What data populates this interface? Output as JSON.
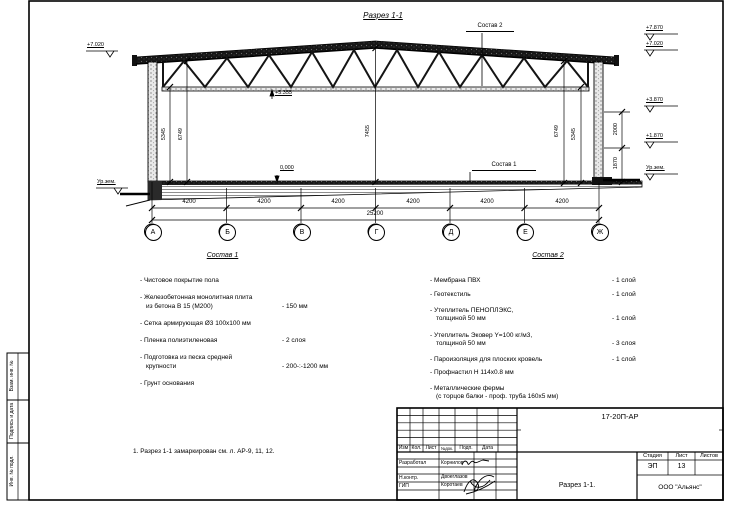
{
  "drawing": {
    "title": "Разрез 1-1",
    "note": "1. Разрез 1-1 замаркирован см. л. АР-9, 11, 12.",
    "callouts": {
      "roof": "Состав 2",
      "floor": "Состав 1"
    },
    "elevations": {
      "left_top": "+7.020",
      "left_ground": "Ур.зем.",
      "right_1": "+7.870",
      "right_2": "+7.020",
      "right_3": "+3.870",
      "right_4": "+1.870",
      "right_ground": "Ур.зем.",
      "truss_bottom": "+5.355",
      "floor_level": "0,000"
    },
    "dims": {
      "v_left_1": "5345",
      "v_left_2": "6749",
      "v_center": "7455",
      "v_right_1": "6749",
      "v_right_2": "5345",
      "side_upper": "2000",
      "side_lower": "1870",
      "spans": [
        "4200",
        "4200",
        "4200",
        "4200",
        "4200",
        "4200"
      ],
      "total": "25200"
    },
    "axes": [
      "А",
      "Б",
      "В",
      "Г",
      "Д",
      "Е",
      "Ж"
    ]
  },
  "sostav1": {
    "title": "Состав 1",
    "items": [
      {
        "text": "- Чистовое покрытие пола",
        "text2": "",
        "value": ""
      },
      {
        "text": "- Железобетонная  монолитная плита",
        "text2": "из бетона В 15 (М200)",
        "value": "- 150 мм"
      },
      {
        "text": "- Сетка армирующая Ø3 100х100 мм",
        "text2": "",
        "value": ""
      },
      {
        "text": "- Пленка полиэтиленовая",
        "text2": "",
        "value": "- 2 слоя"
      },
      {
        "text": "- Подготовка из песка средней",
        "text2": "крупности",
        "value": "- 200-:-1200 мм"
      },
      {
        "text": "- Грунт основания",
        "text2": "",
        "value": ""
      }
    ]
  },
  "sostav2": {
    "title": "Состав 2",
    "items": [
      {
        "text": "- Мембрана ПВХ",
        "text2": "",
        "value": "- 1 слой"
      },
      {
        "text": "- Геотекстиль",
        "text2": "",
        "value": "- 1 слой"
      },
      {
        "text": "- Утеплитель ПЕНОПЛЭКС,",
        "text2": "толщиной 50 мм",
        "value": "- 1 слой"
      },
      {
        "text": "- Утеплитель Эковер Y=100 кг/м3,",
        "text2": "толщиной 50 мм",
        "value": "- 3 слоя"
      },
      {
        "text": "- Пароизоляция для плоских кровель",
        "text2": "",
        "value": "- 1 слой"
      },
      {
        "text": "- Профнастил Н 114х0.8 мм",
        "text2": "",
        "value": ""
      },
      {
        "text": "- Металлические фермы",
        "text2": "(с торцов балки - проф. труба 160х5 мм)",
        "value": ""
      }
    ]
  },
  "titleblock": {
    "doc_number": "17-20П-АР",
    "headers": {
      "izm": "Изм",
      "kol": "Кол.",
      "list": "Лист",
      "ndok": "№док.",
      "podp": "Подп.",
      "data": "Дата"
    },
    "rows": [
      {
        "role": "Разработал",
        "name": "Корнилов"
      },
      {
        "role": "Н.контр.",
        "name": "Двоеглазов"
      },
      {
        "role": "ГИП",
        "name": "Коротаев"
      }
    ],
    "stage_label": "Стадия",
    "sheet_label": "Лист",
    "sheets_label": "Листов",
    "stage": "ЭП",
    "sheet": "13",
    "sheets": "",
    "title": "Разрез 1-1.",
    "company": "ООО \"Альянс\""
  },
  "frame": {
    "labels": [
      "Взам. инв. №",
      "Подпись и дата",
      "Инв. № подл."
    ]
  }
}
